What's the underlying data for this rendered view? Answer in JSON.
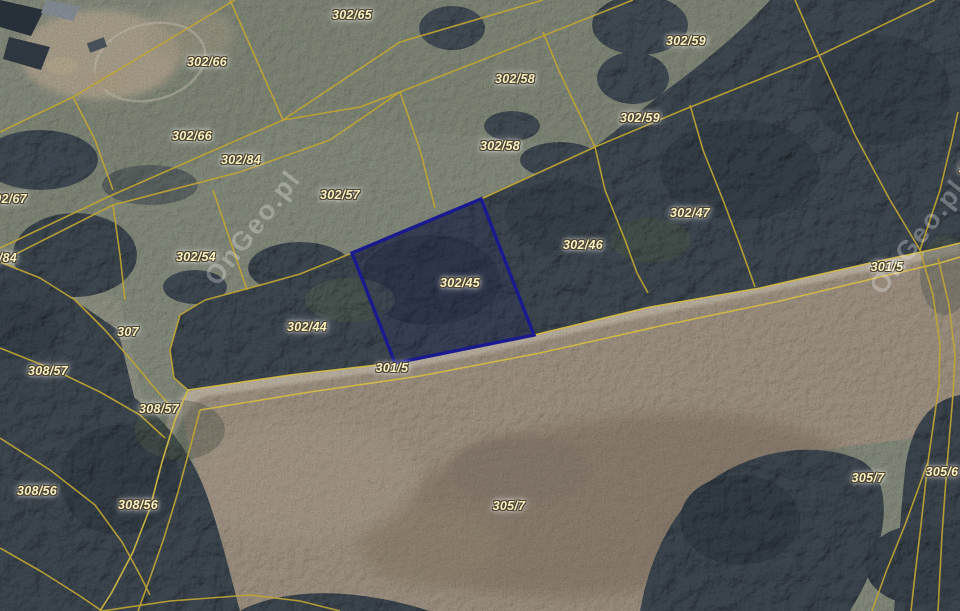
{
  "map": {
    "description": "Cadastral parcel overlay on aerial imagery",
    "watermark_text": "OnGeo.pl",
    "colors": {
      "boundary_line": "#bfa534",
      "boundary_line_bright": "#d6bc43",
      "highlight_outline": "#1a1a8e",
      "label_text": "#f9f0c2",
      "label_outline": "#4b4332",
      "field_green": "#99a191",
      "field_tan": "#b5a795",
      "forest": "#49545e",
      "road": "#d7ccba"
    },
    "highlighted_parcel": {
      "id": "302/45",
      "polygon": [
        [
          481,
          199
        ],
        [
          534,
          335
        ],
        [
          395,
          363
        ],
        [
          352,
          253
        ]
      ]
    },
    "labels": [
      {
        "text": "302/65",
        "x": 352,
        "y": 15
      },
      {
        "text": "302/59",
        "x": 686,
        "y": 41
      },
      {
        "text": "302/66",
        "x": 207,
        "y": 62
      },
      {
        "text": "302/58",
        "x": 515,
        "y": 79
      },
      {
        "text": "302/59",
        "x": 640,
        "y": 118
      },
      {
        "text": "302/66",
        "x": 192,
        "y": 136
      },
      {
        "text": "302/58",
        "x": 500,
        "y": 146
      },
      {
        "text": "302/84",
        "x": 241,
        "y": 160
      },
      {
        "text": "301/5",
        "x": 975,
        "y": 169
      },
      {
        "text": "302/57",
        "x": 340,
        "y": 195
      },
      {
        "text": "302/67",
        "x": 7,
        "y": 199
      },
      {
        "text": "302/47",
        "x": 690,
        "y": 213
      },
      {
        "text": "302/46",
        "x": 583,
        "y": 245
      },
      {
        "text": "302/54",
        "x": 196,
        "y": 257
      },
      {
        "text": "302/84",
        "x": -3,
        "y": 258
      },
      {
        "text": "301/5",
        "x": 887,
        "y": 267
      },
      {
        "text": "302/45",
        "x": 460,
        "y": 283
      },
      {
        "text": "302/44",
        "x": 307,
        "y": 327
      },
      {
        "text": "307",
        "x": 128,
        "y": 332
      },
      {
        "text": "301/5",
        "x": 392,
        "y": 368
      },
      {
        "text": "308/57",
        "x": 48,
        "y": 371
      },
      {
        "text": "308/57",
        "x": 159,
        "y": 409
      },
      {
        "text": "305/6",
        "x": 942,
        "y": 472
      },
      {
        "text": "305/7",
        "x": 868,
        "y": 478
      },
      {
        "text": "308/56",
        "x": 37,
        "y": 491
      },
      {
        "text": "308/56",
        "x": 138,
        "y": 505
      },
      {
        "text": "305/7",
        "x": 509,
        "y": 506
      }
    ],
    "watermarks": [
      {
        "x": 253,
        "y": 228
      },
      {
        "x": 918,
        "y": 237
      }
    ],
    "boundaries": [
      {
        "points": [
          [
            0,
            132
          ],
          [
            73,
            97
          ],
          [
            235,
            0
          ]
        ]
      },
      {
        "points": [
          [
            73,
            97
          ],
          [
            95,
            140
          ],
          [
            113,
            190
          ]
        ]
      },
      {
        "points": [
          [
            0,
            248
          ],
          [
            110,
            196
          ],
          [
            283,
            120
          ]
        ]
      },
      {
        "points": [
          [
            0,
            262
          ],
          [
            113,
            205
          ],
          [
            240,
            172
          ],
          [
            330,
            140
          ],
          [
            400,
            92
          ]
        ]
      },
      {
        "points": [
          [
            230,
            0
          ],
          [
            283,
            120
          ]
        ]
      },
      {
        "points": [
          [
            283,
            120
          ],
          [
            400,
            42
          ],
          [
            543,
            0
          ]
        ]
      },
      {
        "points": [
          [
            283,
            120
          ],
          [
            360,
            107
          ],
          [
            400,
            92
          ],
          [
            500,
            53
          ],
          [
            633,
            0
          ]
        ]
      },
      {
        "points": [
          [
            400,
            92
          ],
          [
            420,
            150
          ],
          [
            435,
            208
          ]
        ]
      },
      {
        "points": [
          [
            543,
            32
          ],
          [
            560,
            73
          ],
          [
            580,
            115
          ],
          [
            595,
            147
          ]
        ]
      },
      {
        "points": [
          [
            795,
            0
          ],
          [
            818,
            53
          ]
        ]
      },
      {
        "points": [
          [
            935,
            0
          ],
          [
            820,
            55
          ],
          [
            683,
            110
          ],
          [
            595,
            147
          ],
          [
            481,
            199
          ],
          [
            352,
            253
          ],
          [
            300,
            274
          ],
          [
            250,
            288
          ],
          [
            205,
            300
          ],
          [
            180,
            315
          ],
          [
            170,
            350
          ],
          [
            174,
            378
          ],
          [
            188,
            390
          ]
        ]
      },
      {
        "points": [
          [
            595,
            147
          ],
          [
            605,
            190
          ],
          [
            625,
            240
          ],
          [
            637,
            273
          ],
          [
            648,
            293
          ]
        ]
      },
      {
        "points": [
          [
            690,
            105
          ],
          [
            703,
            150
          ],
          [
            723,
            200
          ],
          [
            740,
            245
          ],
          [
            755,
            287
          ]
        ]
      },
      {
        "points": [
          [
            818,
            53
          ],
          [
            855,
            135
          ],
          [
            890,
            200
          ],
          [
            920,
            250
          ]
        ]
      },
      {
        "points": [
          [
            920,
            250
          ],
          [
            940,
            190
          ],
          [
            952,
            140
          ],
          [
            958,
            112
          ]
        ]
      },
      {
        "points": [
          [
            188,
            390
          ],
          [
            290,
            375
          ],
          [
            395,
            363
          ],
          [
            534,
            335
          ],
          [
            650,
            307
          ],
          [
            760,
            288
          ],
          [
            870,
            263
          ],
          [
            935,
            249
          ],
          [
            960,
            243
          ]
        ],
        "bright": true
      },
      {
        "points": [
          [
            200,
            410
          ],
          [
            310,
            392
          ],
          [
            420,
            376
          ],
          [
            540,
            353
          ],
          [
            660,
            326
          ],
          [
            780,
            301
          ],
          [
            880,
            277
          ],
          [
            940,
            263
          ],
          [
            960,
            257
          ]
        ],
        "bright": true
      },
      {
        "points": [
          [
            188,
            390
          ],
          [
            175,
            420
          ],
          [
            162,
            462
          ],
          [
            150,
            508
          ],
          [
            133,
            552
          ],
          [
            112,
            592
          ],
          [
            100,
            611
          ]
        ],
        "bright": true
      },
      {
        "points": [
          [
            200,
            410
          ],
          [
            190,
            448
          ],
          [
            178,
            492
          ],
          [
            164,
            538
          ],
          [
            150,
            578
          ],
          [
            138,
            611
          ]
        ]
      },
      {
        "points": [
          [
            213,
            190
          ],
          [
            230,
            240
          ],
          [
            247,
            290
          ]
        ]
      },
      {
        "points": [
          [
            113,
            205
          ],
          [
            120,
            255
          ],
          [
            125,
            300
          ]
        ]
      },
      {
        "points": [
          [
            0,
            262
          ],
          [
            40,
            278
          ],
          [
            75,
            300
          ],
          [
            105,
            330
          ],
          [
            133,
            362
          ],
          [
            158,
            392
          ],
          [
            172,
            408
          ]
        ]
      },
      {
        "points": [
          [
            0,
            348
          ],
          [
            50,
            368
          ],
          [
            100,
            392
          ],
          [
            140,
            415
          ],
          [
            165,
            438
          ]
        ]
      },
      {
        "points": [
          [
            0,
            438
          ],
          [
            50,
            470
          ],
          [
            95,
            505
          ],
          [
            122,
            542
          ],
          [
            140,
            575
          ],
          [
            150,
            595
          ]
        ]
      },
      {
        "points": [
          [
            0,
            548
          ],
          [
            42,
            572
          ],
          [
            80,
            596
          ],
          [
            102,
            611
          ]
        ]
      },
      {
        "points": [
          [
            102,
            611
          ],
          [
            170,
            601
          ],
          [
            250,
            595
          ],
          [
            300,
            601
          ],
          [
            340,
            611
          ]
        ]
      },
      {
        "points": [
          [
            920,
            250
          ],
          [
            933,
            295
          ],
          [
            940,
            345
          ],
          [
            939,
            385
          ],
          [
            928,
            462
          ],
          [
            921,
            525
          ],
          [
            915,
            575
          ],
          [
            911,
            611
          ]
        ]
      },
      {
        "points": [
          [
            938,
            258
          ],
          [
            949,
            305
          ],
          [
            955,
            355
          ],
          [
            953,
            395
          ],
          [
            947,
            465
          ],
          [
            942,
            535
          ],
          [
            938,
            611
          ]
        ]
      },
      {
        "points": [
          [
            928,
            462
          ],
          [
            905,
            525
          ],
          [
            886,
            572
          ],
          [
            872,
            611
          ]
        ]
      }
    ]
  }
}
